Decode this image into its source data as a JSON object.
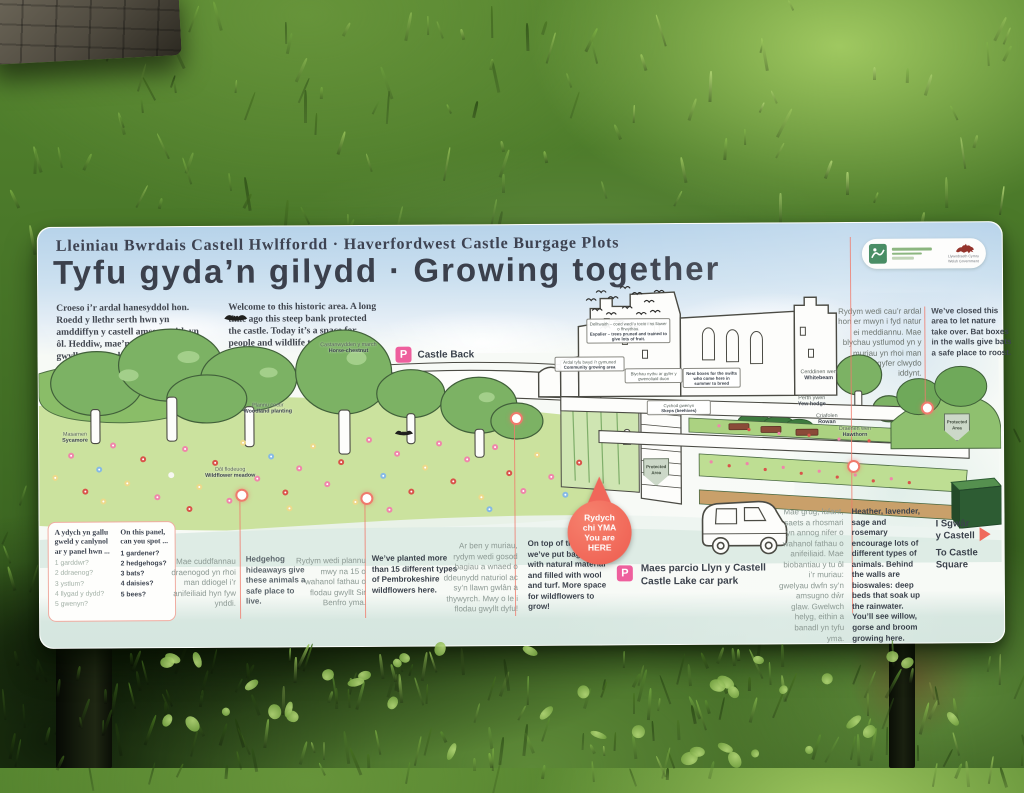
{
  "sign": {
    "header": {
      "subtitle_cy": "Lleiniau Bwrdais Castell Hwlffordd",
      "separator": "·",
      "subtitle_en": "Haverfordwest Castle Burgage Plots",
      "title_cy": "Tyfu gyda’n gilydd",
      "title_separator": "·",
      "title_en": "Growing together"
    },
    "logos": {
      "welsh_government_line1": "Llywodraeth Cymru",
      "welsh_government_line2": "Welsh Government"
    },
    "intro": {
      "cy": "Croeso i’r ardal hanesyddol hon. Roedd y llethr serth hwn yn amddiffyn y castell amser maith yn ôl. Heddiw, mae’n fan i bobl a bywyd gwyllt ei mwynhau.",
      "en": "Welcome to this historic area. A long time ago this steep bank protected the castle. Today it’s a space for people and wildlife to enjoy."
    },
    "closed_area": {
      "cy": "Rydym wedi cau’r ardal hon er mwyn i fyd natur ei meddiannu. Mae blychau ystlumod yn y muriau yn rhoi man ddiogel ar gyfer clwydo iddynt.",
      "en": "We’ve closed this area to let nature take over. Bat boxes in the walls give bats a safe place to roost."
    },
    "spot_panel": {
      "heading_cy": "A ydych yn gallu gweld y canlynol ar y panel hwn ...",
      "heading_en": "On this panel, can you spot ...",
      "items_cy": [
        "1 garddwr?",
        "2 ddraenog?",
        "3 ystlum?",
        "4 llygad y dydd?",
        "5 gwenyn?"
      ],
      "items_en": [
        "1 gardener?",
        "2 hedgehogs?",
        "3 bats?",
        "4 daisies?",
        "5 bees?"
      ]
    },
    "hedgehog": {
      "cy": "Mae cuddfannau draenogod yn rhoi man ddiogel i’r anifeiliaid hyn fyw ynddi.",
      "en": "Hedgehog hideaways give these animals a safe place to live."
    },
    "wildflowers": {
      "cy": "Rydym wedi plannu mwy na 15 o wahanol fathau o flodau gwyllt Sir Benfro yma.",
      "en": "We’ve planted more than 15 different types of Pembrokeshire wildflowers here."
    },
    "walls": {
      "cy": "Ar ben y muriau, rydym wedi gosod bagiau a wnaed o ddeunydd naturiol ac sy’n llawn gwlân a thywyrch. Mwy o le i flodau gwyllt dyfu!",
      "en": "On top of the walls, we’ve put bags made with natural material and filled with wool and turf. More space for wildflowers to grow!"
    },
    "planting": {
      "cy": "Mae grug, lafant, saets a rhosmari yn annog nifer o wahanol fathau o anifeiliaid. Mae biobantiau y tu ôl i’r muriau: gwelyau dwfn sy’n amsugno dŵr glaw. Gwelwch helyg, eithin a banadl yn tyfu yma.",
      "en": "Heather, lavender, sage and rosemary encourage lots of different types of animals. Behind the walls are bioswales: deep beds that soak up the rainwater. You’ll see willow, gorse and broom growing here."
    },
    "map": {
      "p_label": "P",
      "castle_back": "Castle Back",
      "car_park_cy": "Maes parcio Llyn y Castell",
      "car_park_en": "Castle Lake car park",
      "you_are_here": {
        "l1": "Rydych",
        "l2": "chi YMA",
        "l3": "You are",
        "l4": "HERE"
      },
      "castle_square": {
        "cy1": "I Sgwâr",
        "cy2": "y Castell",
        "en1": "To Castle",
        "en2": "Square"
      },
      "protected_area": {
        "l1": "Protected",
        "l2": "Area"
      },
      "labels": [
        {
          "cy": "Masarnen",
          "en": "Sycamore"
        },
        {
          "cy": "Castanwydden y march",
          "en": "Horse-chestnut"
        },
        {
          "cy": "Plannu coetir",
          "en": "Woodland planting"
        },
        {
          "cy": "Dôl flodeuog",
          "en": "Wildflower meadow"
        },
        {
          "cy": "Ardal tyfu bwyd i’r gymuned",
          "en": "Community growing area"
        },
        {
          "cy": "Delltwaith – coed wedi’u tocio i roi llawer o ffrwythau.",
          "en": "Espalier – trees pruned and trained to give lots of fruit."
        },
        {
          "cy": "Blychau nythu ar gyfer y gwenoliaid duon",
          "en": "Nest boxes for the swifts who come here in summer to breed"
        },
        {
          "cy": "Cychod gwenyn",
          "en": "Skeps (beehives)"
        },
        {
          "cy": "Perth ywen",
          "en": "Yew hedge"
        },
        {
          "cy": "Cerddinen wen",
          "en": "Whitebeam"
        },
        {
          "cy": "Criafolen",
          "en": "Rowan"
        },
        {
          "cy": "Draenen wen",
          "en": "Hawthorn"
        }
      ]
    },
    "colors": {
      "accent_coral": "#ef6a5c",
      "accent_pink": "#ee5f9d",
      "ink": "#3b404c",
      "sky": "#cde1f0",
      "meadow": "#cbe29e"
    }
  }
}
